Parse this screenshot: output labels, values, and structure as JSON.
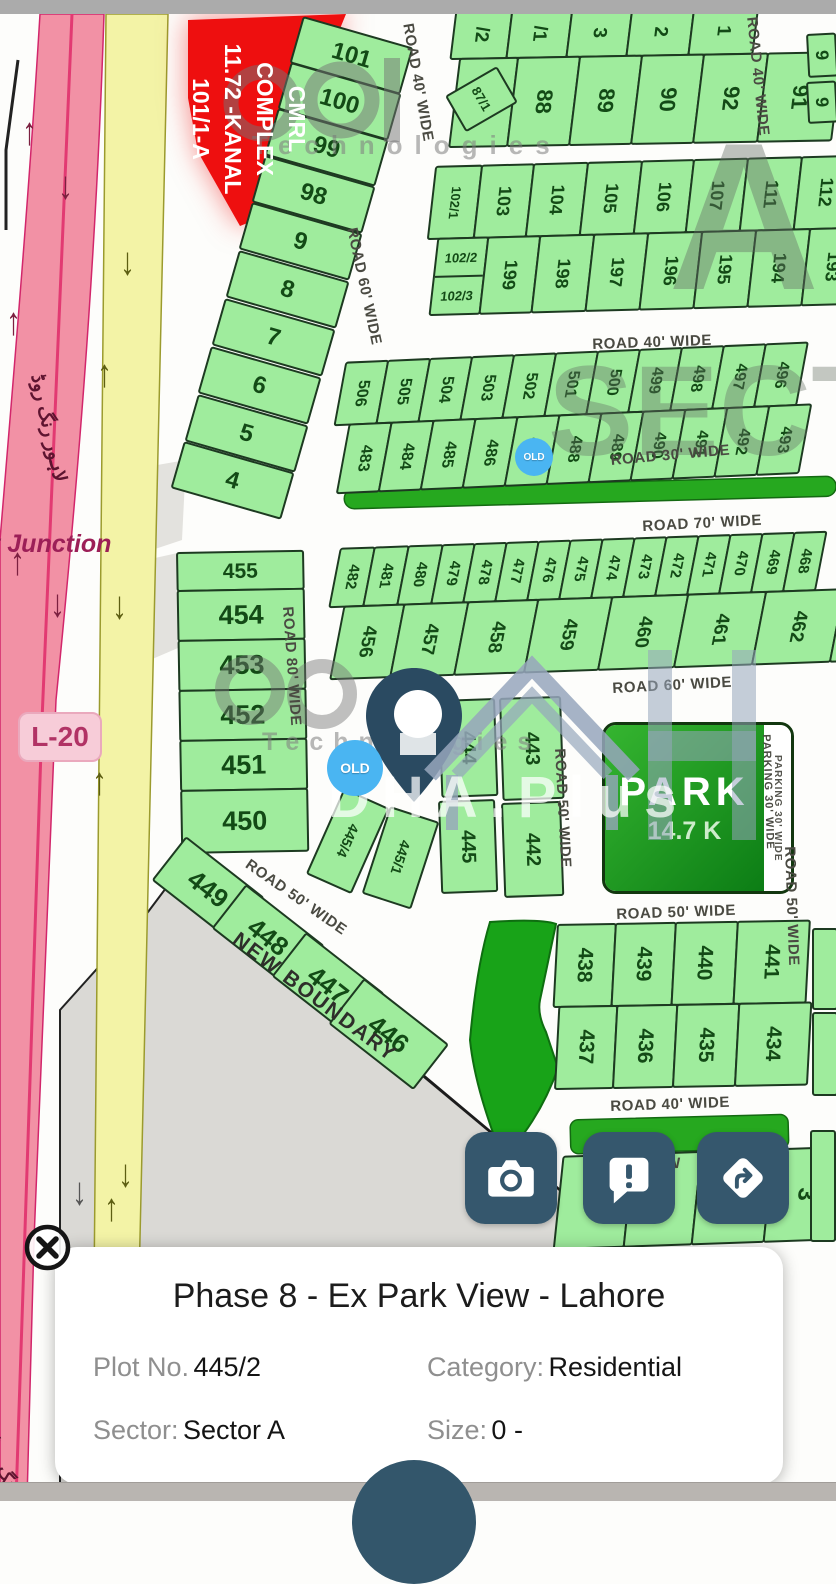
{
  "ui": {
    "card": {
      "title": "Phase 8 - Ex Park View - Lahore",
      "plot_label": "Plot No.",
      "plot_value": "445/2",
      "category_label": "Category:",
      "category_value": "Residential",
      "sector_label": "Sector:",
      "sector_value": "Sector A",
      "size_label": "Size:",
      "size_value": "0 -"
    },
    "buttons": [
      {
        "name": "camera"
      },
      {
        "name": "report"
      },
      {
        "name": "directions"
      }
    ],
    "colors": {
      "accent": "#35576d",
      "plot_fill": "#9fec9d",
      "old_badge": "#4ab5f2",
      "park_green": "#0c7d15",
      "ring_road_pink": "#f291a5",
      "service_road_yellow": "#f3f3a6",
      "complex_red": "#ee0f0f"
    }
  },
  "map": {
    "junction": "t Junction",
    "road_badge": "L-20",
    "urdu_ring_road": "لاہور رنگ روڈ",
    "new_boundary": "NEW BOUNDARY",
    "old_text": "OLD",
    "complex": [
      "CMRL",
      "COMPLEX",
      "11.72 -KANAL",
      "101/1-A"
    ],
    "park": {
      "title": "PARK",
      "size": "14.7 K",
      "parking": "PARKING 30' WIDE"
    },
    "watermarks": {
      "technologies": "Technologies",
      "sector_letter": "A",
      "sector_word": "SECTOR",
      "brand": "DHA.Plus"
    },
    "labels": [
      {
        "t": "ROAD 40' WIDE",
        "x": 416,
        "y": 22,
        "r": 80
      },
      {
        "t": "ROAD 40' WIDE",
        "x": 760,
        "y": 16,
        "r": 84
      },
      {
        "t": "ROAD 60' WIDE",
        "x": 360,
        "y": 226,
        "r": 78
      },
      {
        "t": "ROAD 40' WIDE",
        "x": 592,
        "y": 336,
        "r": -2
      },
      {
        "t": "ROAD 30' WIDE",
        "x": 610,
        "y": 452,
        "r": -5
      },
      {
        "t": "ROAD 70' WIDE",
        "x": 642,
        "y": 518,
        "r": -3
      },
      {
        "t": "ROAD 60' WIDE",
        "x": 612,
        "y": 680,
        "r": -3
      },
      {
        "t": "ROAD 80' WIDE",
        "x": 296,
        "y": 606,
        "r": 86
      },
      {
        "t": "ROAD 50' WIDE",
        "x": 252,
        "y": 856,
        "r": 35
      },
      {
        "t": "ROAD 50' WIDE",
        "x": 568,
        "y": 748,
        "r": 87
      },
      {
        "t": "PARKING 30' WIDE",
        "x": 772,
        "y": 734,
        "r": 88,
        "sm": 1
      },
      {
        "t": "ROAD 50' WIDE",
        "x": 798,
        "y": 846,
        "r": 88
      },
      {
        "t": "ROAD 50' WIDE",
        "x": 616,
        "y": 906,
        "r": -2
      },
      {
        "t": "ROAD 40' WIDE",
        "x": 610,
        "y": 1098,
        "r": -2
      },
      {
        "t": "0' W",
        "x": 648,
        "y": 1156,
        "r": -2
      }
    ],
    "arrows": [
      {
        "g": "↑",
        "x": 22,
        "y": 118,
        "c": "#7c2040"
      },
      {
        "g": "↓",
        "x": 58,
        "y": 172,
        "c": "#7c2040"
      },
      {
        "g": "↑",
        "x": 6,
        "y": 308,
        "c": "#7c2040"
      },
      {
        "g": "↑",
        "x": 10,
        "y": 548,
        "c": "#7c2040"
      },
      {
        "g": "↓",
        "x": 50,
        "y": 590,
        "c": "#7c2040"
      },
      {
        "g": "↓",
        "x": 120,
        "y": 248,
        "c": "#5d5e12"
      },
      {
        "g": "↑",
        "x": 97,
        "y": 360,
        "c": "#5d5e12"
      },
      {
        "g": "↓",
        "x": 112,
        "y": 592,
        "c": "#5d5e12"
      },
      {
        "g": "↑",
        "x": 92,
        "y": 768,
        "c": "#5d5e12"
      },
      {
        "g": "↓",
        "x": 118,
        "y": 1160,
        "c": "#5d5e12"
      },
      {
        "g": "↑",
        "x": 104,
        "y": 1194,
        "c": "#5d5e12"
      },
      {
        "g": "↓",
        "x": 72,
        "y": 1178,
        "c": "#555555"
      }
    ],
    "old_badges": [
      {
        "x": 515,
        "y": 438,
        "d": 38,
        "fs": 10
      },
      {
        "x": 327,
        "y": 740,
        "d": 56,
        "fs": 14
      }
    ],
    "blocks": [
      {
        "x": 452,
        "y": 10,
        "rot": -1,
        "skew": -8,
        "rows": [
          {
            "h": 50,
            "fs": 19,
            "cells": [
              {
                "t": "/2",
                "w": 58
              },
              {
                "t": "/1",
                "w": 62
              },
              {
                "t": "3",
                "w": 62
              },
              {
                "t": "2",
                "w": 64
              },
              {
                "t": "1",
                "w": 66
              }
            ]
          },
          {
            "h": 90,
            "fs": 22,
            "cells": [
              {
                "t": "87",
                "w": 60
              },
              {
                "t": "88",
                "w": 64
              },
              {
                "t": "89",
                "w": 64
              },
              {
                "t": "90",
                "w": 64
              },
              {
                "t": "92",
                "w": 66
              },
              {
                "t": "91",
                "w": 76
              }
            ]
          }
        ]
      },
      {
        "x": 430,
        "y": 166,
        "rot": -1.5,
        "skew": -8,
        "rows": [
          {
            "h": 74,
            "fs": 18,
            "cells": [
              {
                "t": "102/1",
                "w": 48,
                "fs": 13
              },
              {
                "t": "103",
                "w": 54
              },
              {
                "t": "104",
                "w": 56
              },
              {
                "t": "105",
                "w": 56
              },
              {
                "t": "106",
                "w": 54
              },
              {
                "t": "107",
                "w": 56
              },
              {
                "t": "111",
                "w": 56
              },
              {
                "t": "112",
                "w": 58
              }
            ]
          },
          {
            "h": 78,
            "fs": 18,
            "cells": [
              {
                "split": 1,
                "t": "102/2",
                "t2": "102/3",
                "w": 52
              },
              {
                "t": "199",
                "w": 54
              },
              {
                "t": "198",
                "w": 56
              },
              {
                "t": "197",
                "w": 56
              },
              {
                "t": "196",
                "w": 56
              },
              {
                "t": "195",
                "w": 56
              },
              {
                "t": "194",
                "w": 56
              },
              {
                "t": "193",
                "w": 56
              }
            ]
          }
        ]
      },
      {
        "x": 338,
        "y": 362,
        "rot": -2.5,
        "skew": -13,
        "rows": [
          {
            "h": 64,
            "fs": 16,
            "cells": [
              {
                "t": "506",
                "w": 44
              },
              {
                "t": "505",
                "w": 44
              },
              {
                "t": "504",
                "w": 44
              },
              {
                "t": "503",
                "w": 44
              },
              {
                "t": "502",
                "w": 44
              },
              {
                "t": "501",
                "w": 44
              },
              {
                "t": "500",
                "w": 44
              },
              {
                "t": "499",
                "w": 44
              },
              {
                "t": "498",
                "w": 44
              },
              {
                "t": "497",
                "w": 44
              },
              {
                "t": "496",
                "w": 44
              }
            ]
          },
          {
            "h": 70,
            "fs": 16,
            "cells": [
              {
                "t": "483",
                "w": 44
              },
              {
                "t": "484",
                "w": 44
              },
              {
                "t": "485",
                "w": 44
              },
              {
                "t": "486",
                "w": 44
              },
              {
                "t": "487",
                "w": 44
              },
              {
                "t": "488",
                "w": 44
              },
              {
                "t": "489",
                "w": 44
              },
              {
                "t": "490",
                "w": 44
              },
              {
                "t": "491",
                "w": 44
              },
              {
                "t": "492",
                "w": 44
              },
              {
                "t": "493",
                "w": 44
              }
            ]
          }
        ]
      },
      {
        "x": 333,
        "y": 548,
        "rot": -2,
        "skew": -13,
        "rows": [
          {
            "h": 60,
            "fs": 15,
            "cells": [
              {
                "t": "482",
                "w": 36
              },
              {
                "t": "481",
                "w": 36
              },
              {
                "t": "480",
                "w": 36
              },
              {
                "t": "479",
                "w": 34
              },
              {
                "t": "478",
                "w": 34
              },
              {
                "t": "477",
                "w": 34
              },
              {
                "t": "476",
                "w": 34
              },
              {
                "t": "475",
                "w": 34
              },
              {
                "t": "474",
                "w": 34
              },
              {
                "t": "473",
                "w": 34
              },
              {
                "t": "472",
                "w": 34
              },
              {
                "t": "471",
                "w": 34
              },
              {
                "t": "470",
                "w": 34
              },
              {
                "t": "469",
                "w": 34
              },
              {
                "t": "468",
                "w": 34
              }
            ]
          },
          {
            "h": 74,
            "fs": 19,
            "cells": [
              {
                "t": "456",
                "w": 62
              },
              {
                "t": "457",
                "w": 66
              },
              {
                "t": "458",
                "w": 72
              },
              {
                "t": "459",
                "w": 76
              },
              {
                "t": "460",
                "w": 78
              },
              {
                "t": "461",
                "w": 80
              },
              {
                "t": "462",
                "w": 80
              },
              {
                "t": "",
                "w": 40
              }
            ]
          }
        ]
      },
      {
        "x": 176,
        "y": 552,
        "rot": -1,
        "rows": [
          {
            "h": 40,
            "fs": 21,
            "m": "h",
            "cells": [
              {
                "t": "455",
                "w": 128
              }
            ]
          },
          {
            "h": 52,
            "fs": 27,
            "m": "h",
            "cells": [
              {
                "t": "454",
                "w": 128
              }
            ]
          },
          {
            "h": 52,
            "fs": 27,
            "m": "h",
            "cells": [
              {
                "t": "453",
                "w": 128
              }
            ]
          },
          {
            "h": 52,
            "fs": 27,
            "m": "h",
            "cells": [
              {
                "t": "452",
                "w": 128
              }
            ]
          },
          {
            "h": 52,
            "fs": 27,
            "m": "h",
            "cells": [
              {
                "t": "451",
                "w": 128
              }
            ]
          },
          {
            "h": 64,
            "fs": 27,
            "m": "h",
            "cells": [
              {
                "t": "450",
                "w": 128
              }
            ]
          }
        ]
      },
      {
        "x": 554,
        "y": 924,
        "rot": -1,
        "skew": -4,
        "rows": [
          {
            "h": 84,
            "fs": 21,
            "cells": [
              {
                "t": "438",
                "w": 60
              },
              {
                "t": "439",
                "w": 62
              },
              {
                "t": "440",
                "w": 64
              },
              {
                "t": "441",
                "w": 74
              }
            ]
          },
          {
            "h": 84,
            "fs": 21,
            "cells": [
              {
                "t": "437",
                "w": 60
              },
              {
                "t": "436",
                "w": 62
              },
              {
                "t": "435",
                "w": 64
              },
              {
                "t": "434",
                "w": 74
              }
            ]
          }
        ]
      },
      {
        "x": 556,
        "y": 1156,
        "rot": -2,
        "skew": -8,
        "rows": [
          {
            "h": 94,
            "fs": 24,
            "cells": [
              {
                "t": "",
                "w": 72
              },
              {
                "t": "5",
                "w": 70
              },
              {
                "t": "4",
                "w": 74
              },
              {
                "t": "3",
                "w": 76
              },
              {
                "t": "",
                "w": 38
              }
            ]
          }
        ]
      }
    ],
    "cells": [
      {
        "t": "101",
        "x": 303,
        "y": 16,
        "w": 115,
        "h": 49,
        "rot": 16,
        "m": "h",
        "fs": 24
      },
      {
        "t": "100",
        "x": 291,
        "y": 62,
        "w": 115,
        "h": 49,
        "rot": 16,
        "m": "h",
        "fs": 24
      },
      {
        "t": "99",
        "x": 278,
        "y": 108,
        "w": 115,
        "h": 49,
        "rot": 16,
        "m": "h",
        "fs": 24
      },
      {
        "t": "98",
        "x": 265,
        "y": 155,
        "w": 115,
        "h": 49,
        "rot": 16,
        "m": "h",
        "fs": 24
      },
      {
        "t": "9",
        "x": 252,
        "y": 202,
        "w": 115,
        "h": 49,
        "rot": 16,
        "m": "h",
        "fs": 24
      },
      {
        "t": "8",
        "x": 239,
        "y": 250,
        "w": 115,
        "h": 49,
        "rot": 16,
        "m": "h",
        "fs": 24
      },
      {
        "t": "7",
        "x": 225,
        "y": 298,
        "w": 115,
        "h": 49,
        "rot": 16,
        "m": "h",
        "fs": 24
      },
      {
        "t": "6",
        "x": 211,
        "y": 346,
        "w": 115,
        "h": 49,
        "rot": 16,
        "m": "h",
        "fs": 24
      },
      {
        "t": "5",
        "x": 198,
        "y": 394,
        "w": 115,
        "h": 49,
        "rot": 16,
        "m": "h",
        "fs": 24
      },
      {
        "t": "4",
        "x": 184,
        "y": 441,
        "w": 115,
        "h": 49,
        "rot": 16,
        "m": "h",
        "fs": 24
      },
      {
        "t": "87/1",
        "x": 445,
        "y": 96,
        "w": 60,
        "h": 42,
        "rot": -30,
        "fs": 13
      },
      {
        "t": "9",
        "x": 806,
        "y": 34,
        "w": 30,
        "h": 44,
        "rot": -3,
        "fs": 18
      },
      {
        "t": "9",
        "x": 806,
        "y": 82,
        "w": 30,
        "h": 42,
        "rot": -3,
        "fs": 18
      },
      {
        "t": "444",
        "x": 438,
        "y": 700,
        "w": 57,
        "h": 98,
        "rot": -2,
        "fs": 20
      },
      {
        "t": "443",
        "x": 499,
        "y": 698,
        "w": 62,
        "h": 103,
        "rot": -2,
        "fs": 20
      },
      {
        "t": "445",
        "x": 438,
        "y": 801,
        "w": 57,
        "h": 93,
        "rot": -2,
        "fs": 20
      },
      {
        "t": "442",
        "x": 501,
        "y": 803,
        "w": 60,
        "h": 95,
        "rot": -2,
        "fs": 20
      },
      {
        "t": "445/1",
        "x": 390,
        "y": 806,
        "w": 52,
        "h": 92,
        "rot": 18,
        "fs": 14
      },
      {
        "t": "445/4",
        "x": 344,
        "y": 788,
        "w": 50,
        "h": 94,
        "rot": 24,
        "fs": 14
      },
      {
        "t": "449",
        "x": 186,
        "y": 836,
        "w": 100,
        "h": 56,
        "rot": 38,
        "m": "h",
        "fs": 26
      },
      {
        "t": "448",
        "x": 246,
        "y": 884,
        "w": 100,
        "h": 56,
        "rot": 38,
        "m": "h",
        "fs": 26
      },
      {
        "t": "447",
        "x": 306,
        "y": 932,
        "w": 100,
        "h": 56,
        "rot": 38,
        "m": "h",
        "fs": 26
      },
      {
        "t": "446",
        "x": 364,
        "y": 978,
        "w": 108,
        "h": 58,
        "rot": 38,
        "m": "h",
        "fs": 26
      },
      {
        "t": "",
        "x": 812,
        "y": 928,
        "w": 26,
        "h": 82,
        "rot": 0
      },
      {
        "t": "",
        "x": 812,
        "y": 1012,
        "w": 26,
        "h": 84,
        "rot": 0
      },
      {
        "t": "",
        "x": 810,
        "y": 1130,
        "w": 26,
        "h": 112,
        "rot": 0
      }
    ]
  }
}
